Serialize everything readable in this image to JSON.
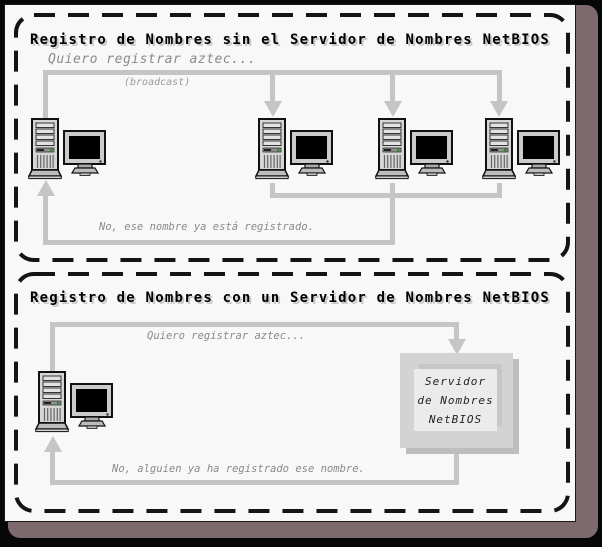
{
  "diagram": {
    "panel1": {
      "title": "Registro de Nombres sin el Servidor de Nombres NetBIOS",
      "request_message": "Quiero registrar aztec...",
      "broadcast_label": "(broadcast)",
      "reply_message": "No, ese nombre ya está registrado."
    },
    "panel2": {
      "title": "Registro de Nombres con un Servidor de Nombres NetBIOS",
      "request_message": "Quiero registrar aztec...",
      "reply_message": "No, alguien ya ha registrado ese nombre.",
      "server_box": {
        "line1": "Servidor",
        "line2": "de Nombres",
        "line3": "NetBIOS"
      }
    },
    "icons": {
      "computer": "desktop-computer-icon",
      "server": "server-box"
    },
    "colors": {
      "page_background": "#f8f8f8",
      "frame_shadow": "#7d6a6c",
      "outer_border": "#000000",
      "panel_border": "#141414",
      "flow_line": "#c5c5c5",
      "message_text": "#8a8a8a",
      "title_text": "#000000",
      "title_shadow": "#c8c8c8",
      "server_box_fill": "#d3d3d3",
      "server_box_inner": "#ebebeb",
      "led_green": "#2e8b2e"
    }
  }
}
